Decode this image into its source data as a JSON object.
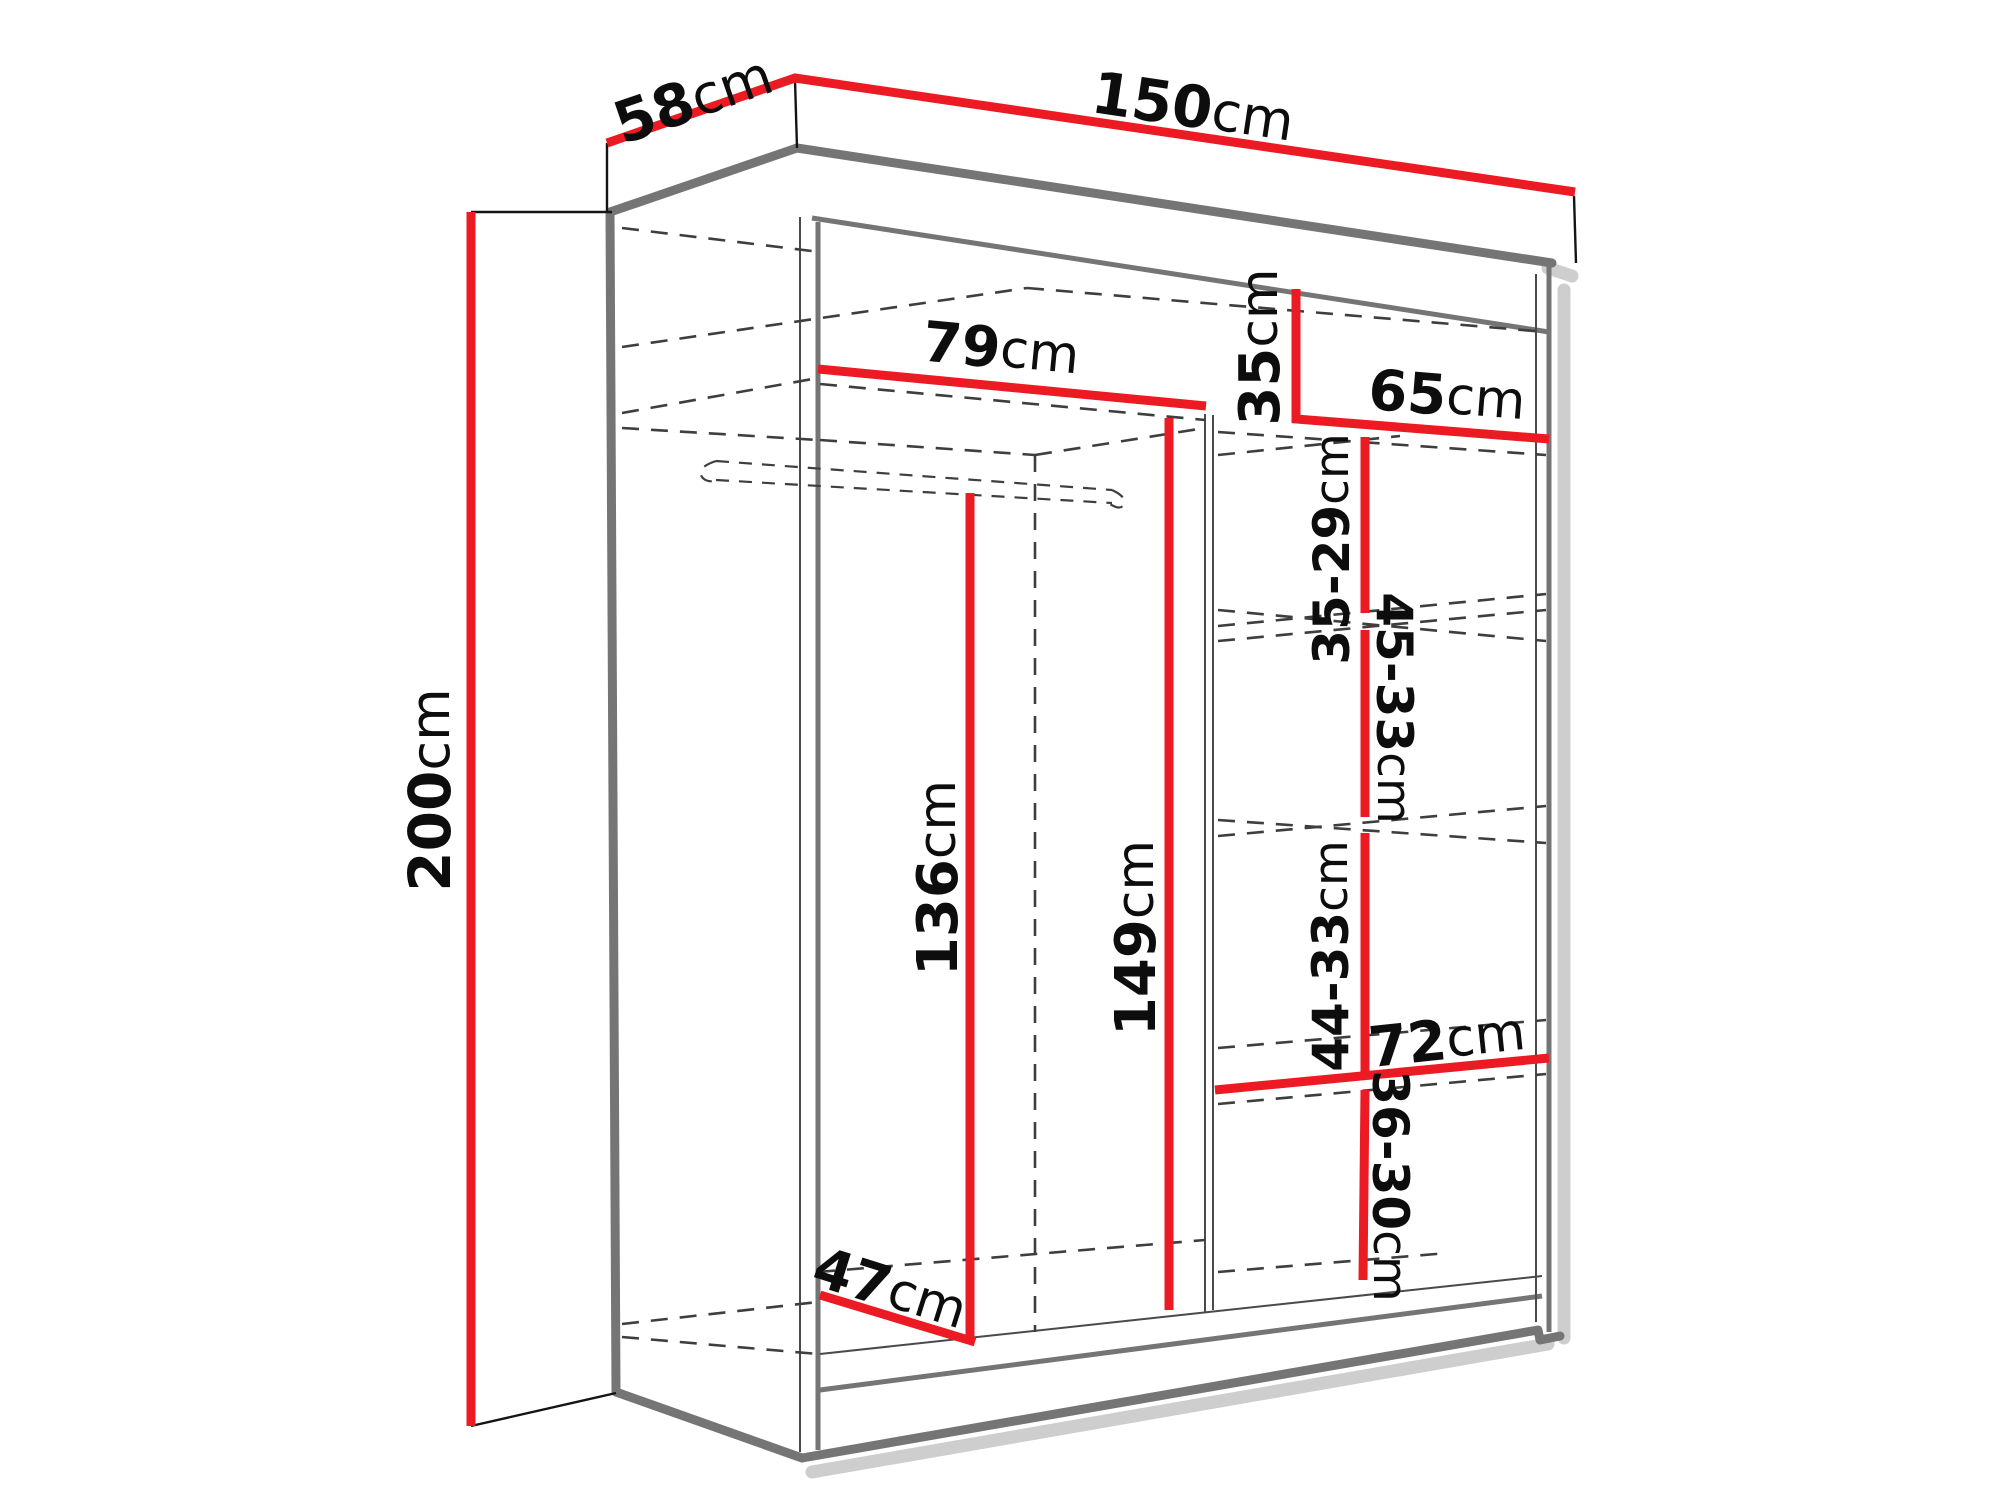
{
  "diagram": {
    "type": "wardrobe-dimension-diagram",
    "unit": "cm",
    "accent_color": "#ec1b23",
    "background_color": "#ffffff",
    "labels": {
      "depth": {
        "value": "58",
        "unit": "cm"
      },
      "width": {
        "value": "150",
        "unit": "cm"
      },
      "height": {
        "value": "200",
        "unit": "cm"
      },
      "left_top_width": {
        "value": "79",
        "unit": "cm"
      },
      "top_shelf_height": {
        "value": "35",
        "unit": "cm"
      },
      "right_width": {
        "value": "65",
        "unit": "cm"
      },
      "shelf_gap_1": {
        "value": "35-29",
        "unit": "cm"
      },
      "shelf_gap_2": {
        "value": "45-33",
        "unit": "cm"
      },
      "shelf_gap_3": {
        "value": "44-33",
        "unit": "cm"
      },
      "shelf_width": {
        "value": "72",
        "unit": "cm"
      },
      "shelf_gap_4": {
        "value": "36-30",
        "unit": "cm"
      },
      "hanging_height": {
        "value": "136",
        "unit": "cm"
      },
      "center_height": {
        "value": "149",
        "unit": "cm"
      },
      "interior_depth": {
        "value": "47",
        "unit": "cm"
      }
    }
  }
}
